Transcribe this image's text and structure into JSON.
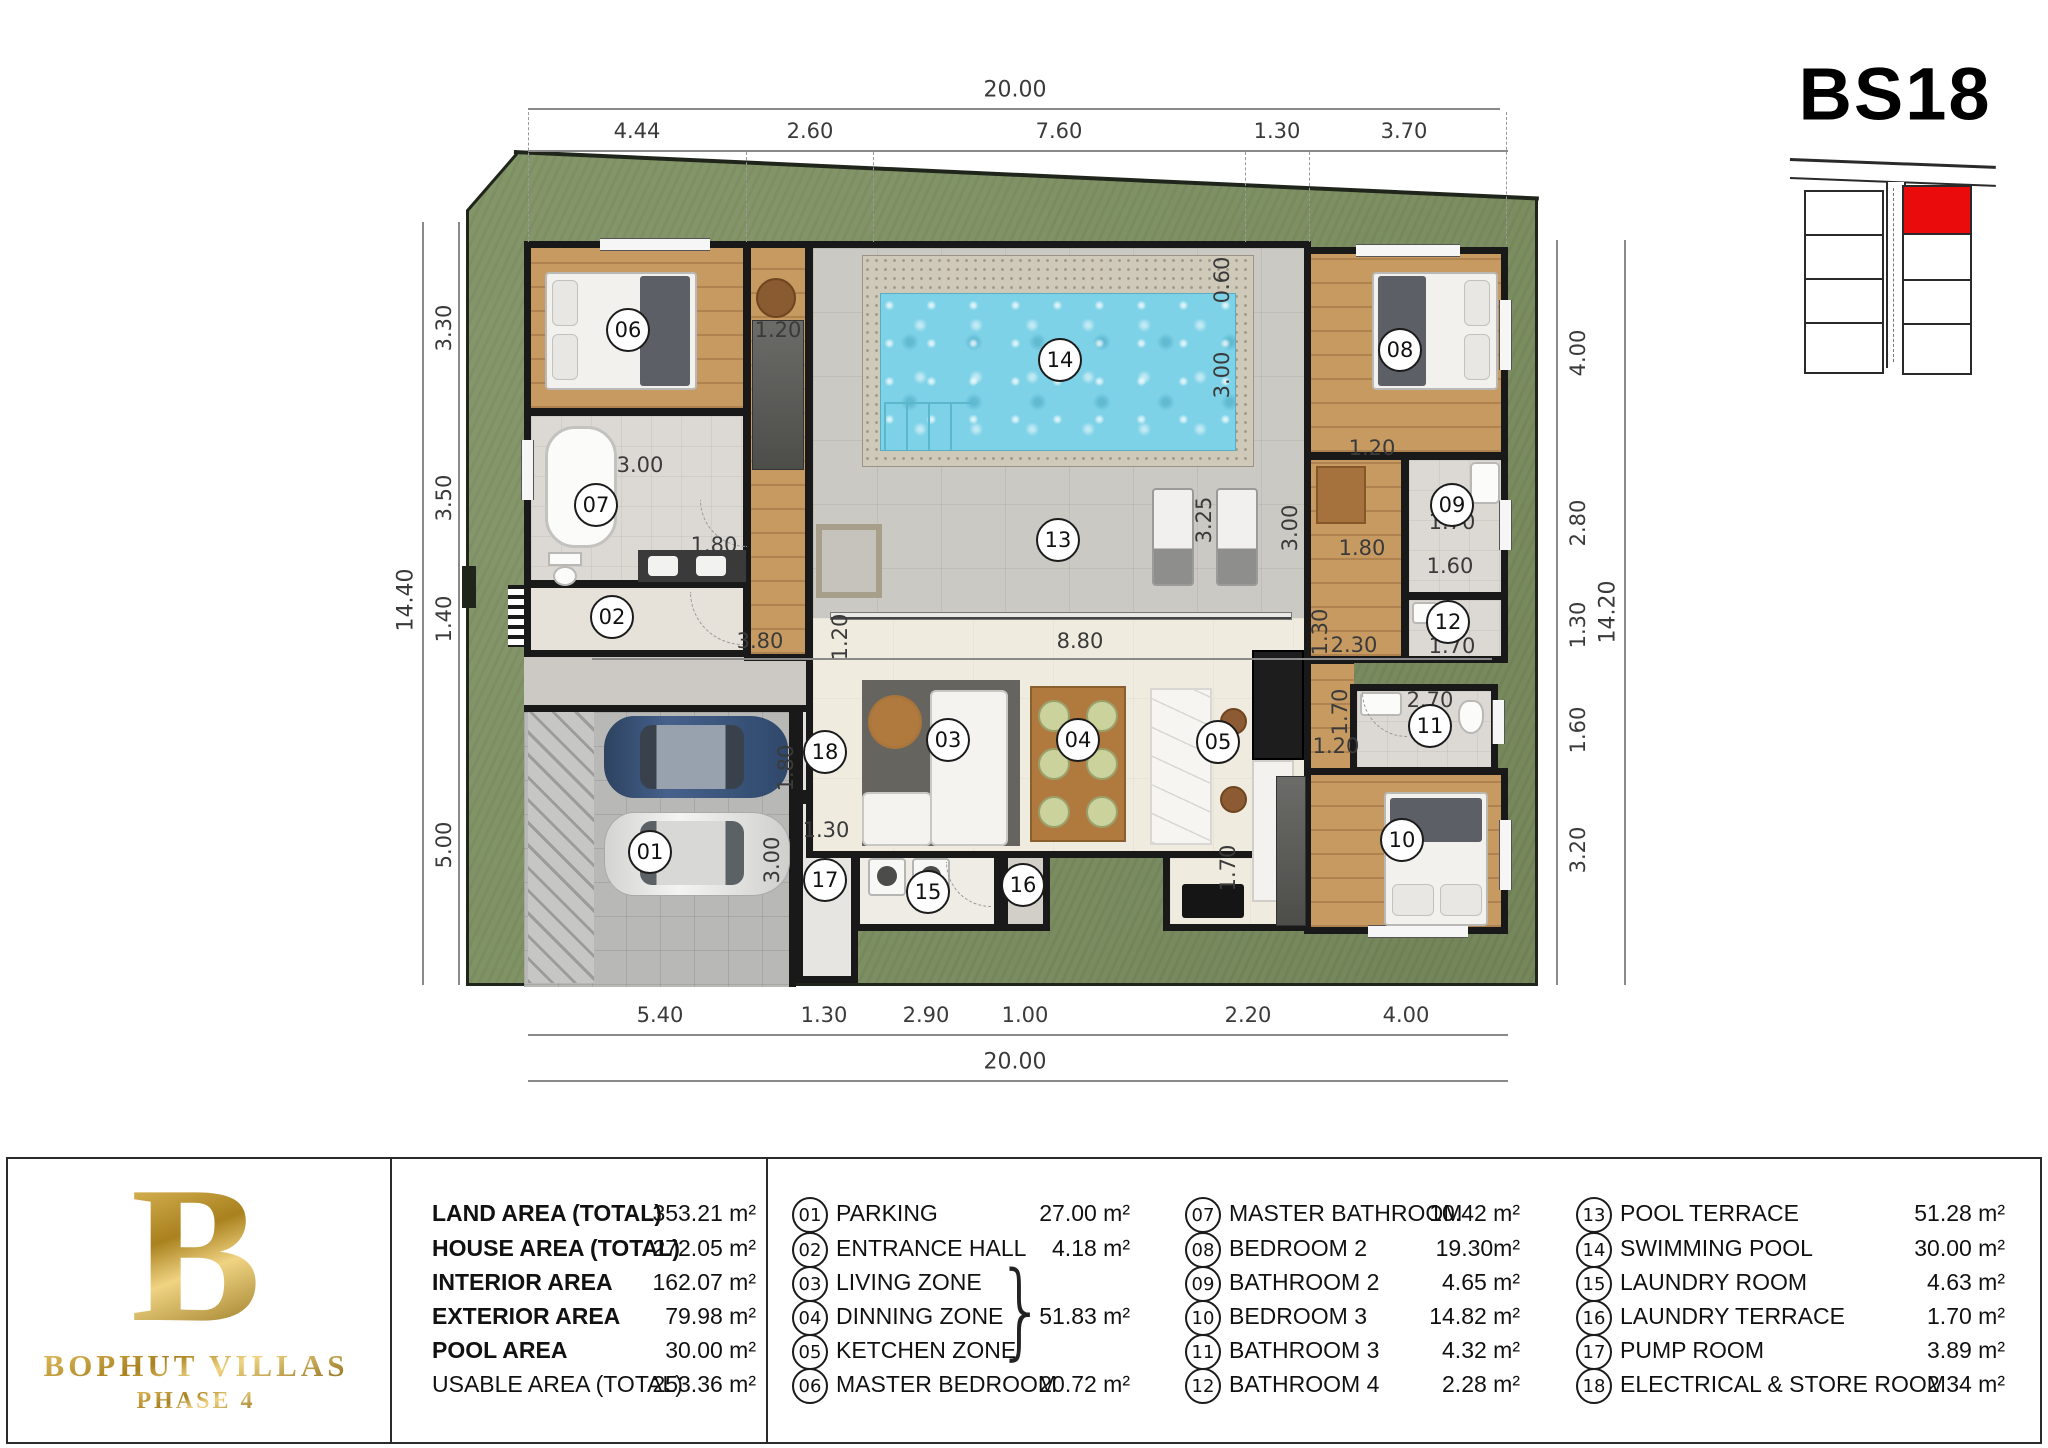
{
  "title": "BS18",
  "logo": {
    "letter": "B",
    "brand": "BOPHUT VILLAS",
    "phase": "PHASE 4"
  },
  "site_map": {
    "highlight_color": "#ea0c0c",
    "rows_left": 4,
    "rows_right": 4
  },
  "colors": {
    "lawn": "#7e9162",
    "pool_water": "#7ed2e7",
    "wood": "#c79a62",
    "wall": "#191919",
    "gold": "#b08a2e",
    "terrace": "#cbc9c3",
    "red_plot": "#ea0c0c"
  },
  "legend": {
    "areas": [
      {
        "label": "LAND AREA (TOTAL)",
        "value": "353.21 m²"
      },
      {
        "label": "HOUSE AREA (TOTAL)",
        "value": "272.05 m²"
      },
      {
        "label": "INTERIOR AREA",
        "value": "162.07 m²"
      },
      {
        "label": "EXTERIOR AREA",
        "value": "79.98 m²"
      },
      {
        "label": "POOL AREA",
        "value": "30.00 m²"
      },
      {
        "label": "USABLE AREA (TOTAL)",
        "value": "253.36 m²"
      }
    ],
    "brace_glyph": "}",
    "columns": [
      {
        "rows": [
          {
            "num": "01",
            "label": "PARKING",
            "value": "27.00 m²"
          },
          {
            "num": "02",
            "label": "ENTRANCE HALL",
            "value": "4.18 m²"
          },
          {
            "num": "03",
            "label": "LIVING ZONE",
            "value": ""
          },
          {
            "num": "04",
            "label": "DINNING ZONE",
            "value": "51.83 m²"
          },
          {
            "num": "05",
            "label": "KETCHEN ZONE",
            "value": ""
          },
          {
            "num": "06",
            "label": "MASTER BEDROOM",
            "value": "20.72 m²"
          }
        ]
      },
      {
        "rows": [
          {
            "num": "07",
            "label": "MASTER BATHROOM",
            "value": "10.42 m²"
          },
          {
            "num": "08",
            "label": "BEDROOM 2",
            "value": "19.30m²"
          },
          {
            "num": "09",
            "label": "BATHROOM 2",
            "value": "4.65 m²"
          },
          {
            "num": "10",
            "label": "BEDROOM 3",
            "value": "14.82 m²"
          },
          {
            "num": "11",
            "label": "BATHROOM 3",
            "value": "4.32 m²"
          },
          {
            "num": "12",
            "label": "BATHROOM 4",
            "value": "2.28 m²"
          }
        ]
      },
      {
        "rows": [
          {
            "num": "13",
            "label": "POOL TERRACE",
            "value": "51.28 m²"
          },
          {
            "num": "14",
            "label": "SWIMMING POOL",
            "value": "30.00 m²"
          },
          {
            "num": "15",
            "label": "LAUNDRY ROOM",
            "value": "4.63 m²"
          },
          {
            "num": "16",
            "label": "LAUNDRY TERRACE",
            "value": "1.70 m²"
          },
          {
            "num": "17",
            "label": "PUMP ROOM",
            "value": "3.89 m²"
          },
          {
            "num": "18",
            "label": "ELECTRICAL & STORE ROOM",
            "value": "2.34 m²"
          }
        ]
      }
    ]
  },
  "plan": {
    "badges": [
      "01",
      "02",
      "03",
      "04",
      "05",
      "06",
      "07",
      "08",
      "09",
      "10",
      "11",
      "12",
      "13",
      "14",
      "15",
      "16",
      "17",
      "18"
    ],
    "dims": {
      "top_total": "20.00",
      "bottom_total": "20.00",
      "left_total": "14.40",
      "right_total": "14.20",
      "top": [
        "4.44",
        "2.60",
        "7.60",
        "1.30",
        "3.70"
      ],
      "bottom": [
        "5.40",
        "1.30",
        "2.90",
        "1.00",
        "2.20",
        "4.00"
      ],
      "left": [
        "3.30",
        "3.50",
        "1.40",
        "5.00"
      ],
      "right": [
        "4.00",
        "2.80",
        "1.30",
        "1.60",
        "3.20"
      ],
      "interior": [
        "3.00",
        "1.20",
        "1.80",
        "0.60",
        "3.00",
        "3.25",
        "3.00",
        "1.30",
        "3.80",
        "1.20",
        "8.80",
        "2.30",
        "1.70",
        "1.70",
        "1.60",
        "1.20",
        "1.80",
        "2.70",
        "1.70",
        "1.20",
        "1.70",
        "1.80",
        "1.30",
        "3.00"
      ]
    }
  }
}
